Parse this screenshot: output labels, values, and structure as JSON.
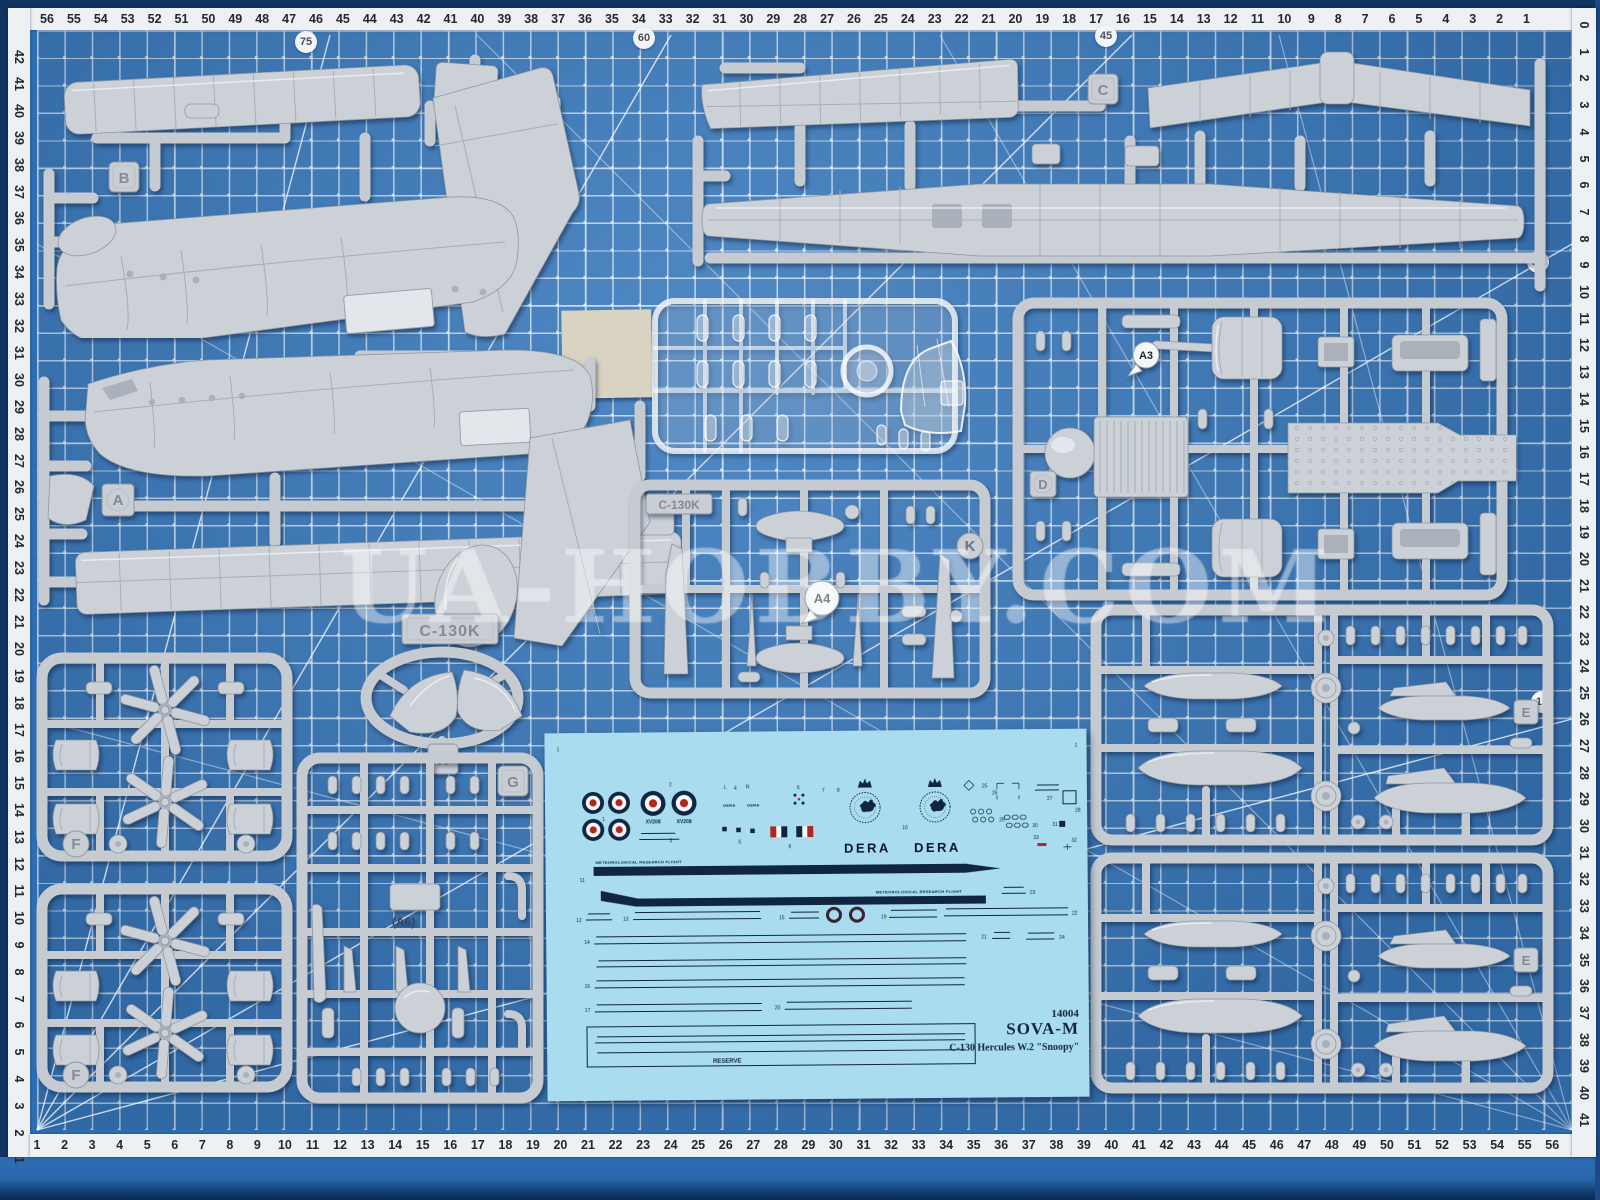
{
  "colors": {
    "mat": "#3c7cbe",
    "mat_dark": "#10345f",
    "grid_line": "#dcebfa",
    "ruler_bg": "#eef1f3",
    "ruler_text": "#23282e",
    "sprue": "#ccd1d8",
    "sprue_runner": "#c6cbd2",
    "sprue_shadow": "#8f96a0",
    "decal_bg": "#a9dcee",
    "decal_navy": "#102540",
    "roundel_red": "#b0281c",
    "roundel_blue": "#1d2f5a",
    "film_cream": "#d9d3c2"
  },
  "watermark": {
    "text": "UA-HOBBY.COM"
  },
  "mat": {
    "angle_labels": [
      {
        "t": "75",
        "x": 306,
        "y": 42
      },
      {
        "t": "60",
        "x": 644,
        "y": 38
      },
      {
        "t": "45",
        "x": 1106,
        "y": 36
      },
      {
        "t": "30",
        "x": 1538,
        "y": 262
      },
      {
        "t": "15",
        "x": 1542,
        "y": 702
      }
    ],
    "rulers": {
      "top": [
        "56",
        "55",
        "54",
        "53",
        "52",
        "51",
        "50",
        "49",
        "48",
        "47",
        "46",
        "45",
        "44",
        "43",
        "42",
        "41",
        "40",
        "39",
        "38",
        "37",
        "36",
        "35",
        "34",
        "33",
        "32",
        "31",
        "30",
        "29",
        "28",
        "27",
        "26",
        "25",
        "24",
        "23",
        "22",
        "21",
        "20",
        "19",
        "18",
        "17",
        "16",
        "15",
        "14",
        "13",
        "12",
        "11",
        "10",
        "9",
        "8",
        "7",
        "6",
        "5",
        "4",
        "3",
        "2",
        "1"
      ],
      "left": [
        "42",
        "41",
        "40",
        "39",
        "38",
        "37",
        "36",
        "35",
        "34",
        "33",
        "32",
        "31",
        "30",
        "29",
        "28",
        "27",
        "26",
        "25",
        "24",
        "23",
        "22",
        "21",
        "20",
        "19",
        "18",
        "17",
        "16",
        "15",
        "14",
        "13",
        "12",
        "11",
        "10",
        "9",
        "8",
        "7",
        "6",
        "5",
        "4",
        "3",
        "2",
        "1"
      ],
      "bottom": [
        "1",
        "2",
        "3",
        "4",
        "5",
        "6",
        "7",
        "8",
        "9",
        "10",
        "11",
        "12",
        "13",
        "14",
        "15",
        "16",
        "17",
        "18",
        "19",
        "20",
        "21",
        "22",
        "23",
        "24",
        "25",
        "26",
        "27",
        "28",
        "29",
        "30",
        "31",
        "32",
        "33",
        "34",
        "35",
        "36",
        "37",
        "38",
        "39",
        "40",
        "41",
        "42",
        "43",
        "44",
        "45",
        "46",
        "47",
        "48",
        "49",
        "50",
        "51",
        "52",
        "53",
        "54",
        "55",
        "56"
      ],
      "right": [
        "0",
        "1",
        "2",
        "3",
        "4",
        "5",
        "6",
        "7",
        "8",
        "9",
        "10",
        "11",
        "12",
        "13",
        "14",
        "15",
        "16",
        "17",
        "18",
        "19",
        "20",
        "21",
        "22",
        "23",
        "24",
        "25",
        "26",
        "27",
        "28",
        "29",
        "30",
        "31",
        "32",
        "33",
        "34",
        "35",
        "36",
        "37",
        "38",
        "39",
        "40",
        "41"
      ]
    }
  },
  "sprues": {
    "plate": "C-130K",
    "a6": "(A6)",
    "tags": {
      "a": "A",
      "b": "B",
      "c": "C",
      "d": "D",
      "e": "E",
      "f": "F",
      "g": "G",
      "k": "K",
      "x": "X",
      "a3": "A3",
      "a4": "A4"
    }
  },
  "decal": {
    "dera": "DERA",
    "serial": "XV208",
    "mrf": "METEOROLOGICAL RESEARCH FLIGHT",
    "crest": "METEOROLOGICAL OFFICE",
    "reserve": "RESERVE",
    "kit_number": "14004",
    "brand": "SOVA-M",
    "kit_name": "C-130 Hercules W.2 \"Snoopy\"",
    "tiny_labels": [
      {
        "t": "1",
        "x": 57,
        "y": 88
      },
      {
        "t": "2",
        "x": 124,
        "y": 54
      },
      {
        "t": "3",
        "x": 124,
        "y": 110
      },
      {
        "t": "4",
        "x": 189,
        "y": 58
      },
      {
        "t": "5",
        "x": 193,
        "y": 112
      },
      {
        "t": "6",
        "x": 252,
        "y": 58
      },
      {
        "t": "7",
        "x": 277,
        "y": 61
      },
      {
        "t": "8",
        "x": 292,
        "y": 61
      },
      {
        "t": "9",
        "x": 243,
        "y": 117
      },
      {
        "t": "10",
        "x": 357,
        "y": 99
      },
      {
        "t": "11",
        "x": 34,
        "y": 149
      },
      {
        "t": "12",
        "x": 30,
        "y": 189
      },
      {
        "t": "13",
        "x": 77,
        "y": 188
      },
      {
        "t": "14",
        "x": 38,
        "y": 211
      },
      {
        "t": "15",
        "x": 233,
        "y": 188
      },
      {
        "t": "16",
        "x": 38,
        "y": 255
      },
      {
        "t": "17",
        "x": 38,
        "y": 279
      },
      {
        "t": "18",
        "x": 293,
        "y": 172
      },
      {
        "t": "19",
        "x": 335,
        "y": 188
      },
      {
        "t": "20",
        "x": 228,
        "y": 278
      },
      {
        "t": "21",
        "x": 435,
        "y": 209
      },
      {
        "t": "22",
        "x": 526,
        "y": 186
      },
      {
        "t": "23",
        "x": 484,
        "y": 165
      },
      {
        "t": "24",
        "x": 513,
        "y": 210
      },
      {
        "t": "25",
        "x": 437,
        "y": 58
      },
      {
        "t": "26",
        "x": 447,
        "y": 65
      },
      {
        "t": "27",
        "x": 502,
        "y": 71
      },
      {
        "t": "28",
        "x": 530,
        "y": 83
      },
      {
        "t": "29",
        "x": 454,
        "y": 92
      },
      {
        "t": "30",
        "x": 487,
        "y": 98
      },
      {
        "t": "31",
        "x": 507,
        "y": 97
      },
      {
        "t": "32",
        "x": 526,
        "y": 113
      },
      {
        "t": "33",
        "x": 488,
        "y": 110
      },
      {
        "t": "L",
        "x": 179,
        "y": 57
      },
      {
        "t": "R",
        "x": 201,
        "y": 57
      },
      {
        "t": "1",
        "x": 12,
        "y": 18
      },
      {
        "t": "1",
        "x": 530,
        "y": 18
      }
    ]
  }
}
